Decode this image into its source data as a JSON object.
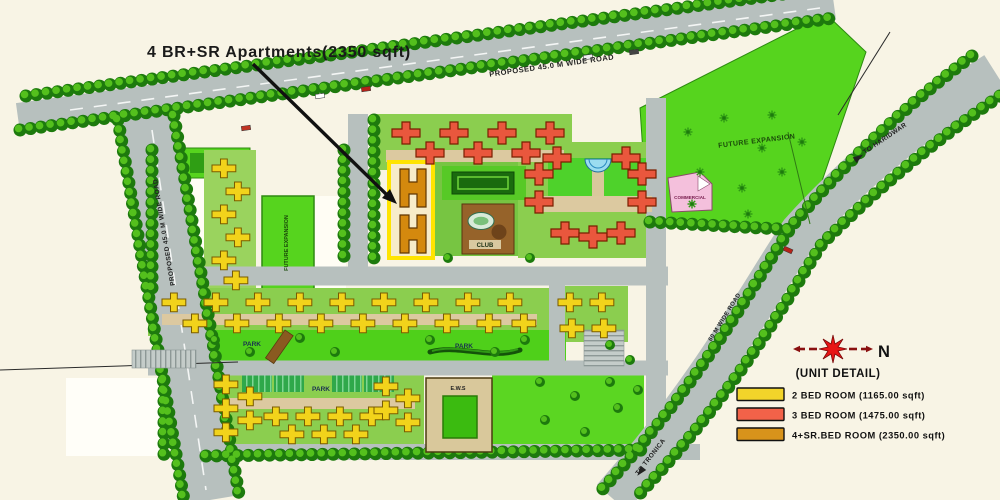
{
  "annotation": {
    "text": "4 BR+SR Apartments(2350 sqft)"
  },
  "roads": {
    "top_label": "PROPOSED 45.0 M WIDE ROAD",
    "left_label": "PROPOSED 45.0 M WIDE ROAD",
    "right_label": "60 M WIDE ROAD",
    "dest_top_right": "TO HARIDWAR",
    "dest_bottom": "TO TRONICA"
  },
  "areas": {
    "future_expansion_ne": "FUTURE EXPANSION",
    "future_expansion_west": "FUTURE EXPANSION",
    "commercial": "COMMERCIAL",
    "club": "CLUB",
    "park": "PARK",
    "ews": "E.W.S"
  },
  "compass": {
    "north_label": "N"
  },
  "legend": {
    "title": "(UNIT DETAIL)",
    "items": [
      {
        "label": "2 BED ROOM (1165.00 sqft)",
        "color": "#f2d42a"
      },
      {
        "label": "3 BED ROOM (1475.00 sqft)",
        "color": "#f26249"
      },
      {
        "label": "4+SR.BED ROOM (2350.00 sqft)",
        "color": "#d8931b"
      }
    ]
  },
  "map_colors": {
    "background": "#f8f4e5",
    "road": "#b7c0be",
    "tree_dark": "#1d7a0d",
    "tree_light": "#54c01d",
    "lawn": "#8bce4f",
    "park_green": "#4fd01a",
    "bldg_2br": "#f2d31b",
    "bldg_3br": "#e9573d",
    "bldg_4br_sr": "#d4890e",
    "highlight_box": "#ffe400",
    "club_brown": "#96632a",
    "commercial_pink": "#f4c0dc",
    "water": "#9adcf0",
    "path_tan": "#dcc9a0",
    "compass_red": "#e81515"
  }
}
